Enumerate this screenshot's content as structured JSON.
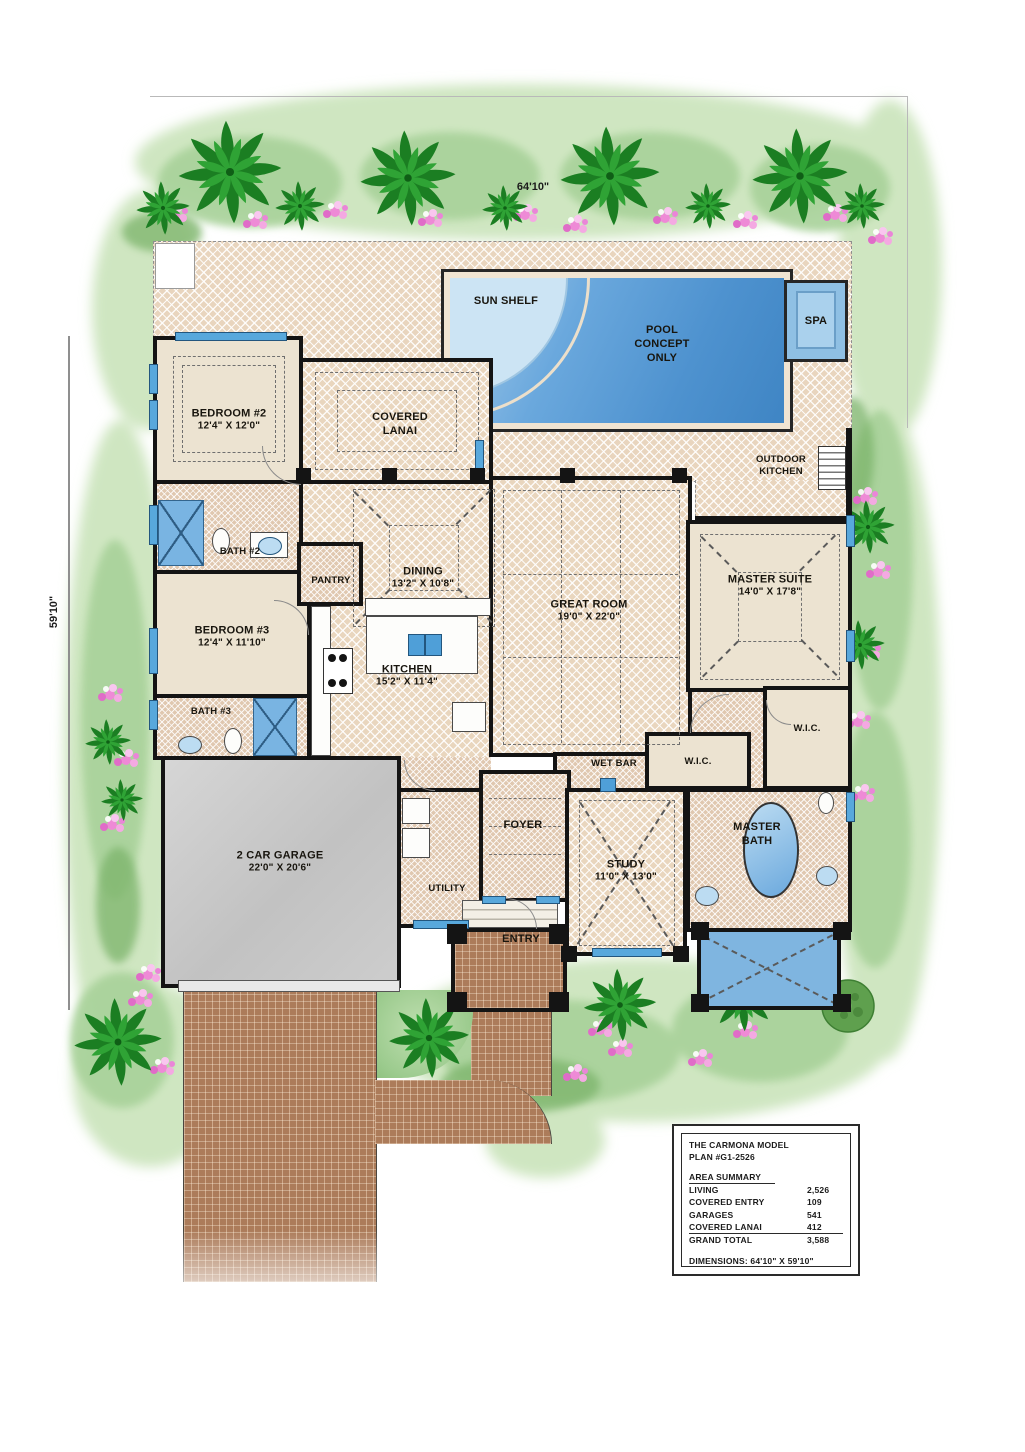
{
  "plan": {
    "top_dimension": "64'10\"",
    "left_dimension": "59'10\""
  },
  "rooms": {
    "sun_shelf": {
      "name": "SUN SHELF"
    },
    "pool": {
      "name": "POOL CONCEPT ONLY"
    },
    "spa": {
      "name": "SPA"
    },
    "outdoor_kitchen": {
      "name": "OUTDOOR KITCHEN"
    },
    "covered_lanai": {
      "name": "COVERED LANAI"
    },
    "bedroom2": {
      "name": "BEDROOM #2",
      "dims": "12'4\" X 12'0\""
    },
    "bath2": {
      "name": "BATH #2"
    },
    "pantry": {
      "name": "PANTRY"
    },
    "dining": {
      "name": "DINING",
      "dims": "13'2\" X 10'8\""
    },
    "great_room": {
      "name": "GREAT ROOM",
      "dims": "19'0\" X 22'0\""
    },
    "master_suite": {
      "name": "MASTER SUITE",
      "dims": "14'0\" X 17'8\""
    },
    "bedroom3": {
      "name": "BEDROOM #3",
      "dims": "12'4\" X 11'10\""
    },
    "bath3": {
      "name": "BATH #3"
    },
    "kitchen": {
      "name": "KITCHEN",
      "dims": "15'2\" X 11'4\""
    },
    "wet_bar": {
      "name": "WET BAR"
    },
    "wic_hall": {
      "name": "W.I.C."
    },
    "wic_master": {
      "name": "W.I.C."
    },
    "garage": {
      "name": "2 CAR GARAGE",
      "dims": "22'0\" X 20'6\""
    },
    "utility": {
      "name": "UTILITY"
    },
    "foyer": {
      "name": "FOYER"
    },
    "study": {
      "name": "STUDY",
      "dims": "11'0\" X 13'0\""
    },
    "master_bath": {
      "name": "MASTER BATH"
    },
    "entry": {
      "name": "ENTRY"
    }
  },
  "title_block": {
    "line1": "THE CARMONA  MODEL",
    "line2": "PLAN #G1-2526",
    "section": "AREA SUMMARY",
    "rows": [
      {
        "label": "LIVING",
        "value": "2,526"
      },
      {
        "label": "COVERED ENTRY",
        "value": "109"
      },
      {
        "label": "GARAGES",
        "value": "541"
      },
      {
        "label": "COVERED LANAI",
        "value": "412"
      },
      {
        "label": "GRAND TOTAL",
        "value": "3,588"
      }
    ],
    "dimensions": "DIMENSIONS: 64'10\" X 59'10\""
  },
  "colors": {
    "wall": "#141414",
    "deck": "#efe0cb",
    "floor": "#ece3d1",
    "tile": "#ecd9c4",
    "pool": "#4e92cf",
    "pool_light": "#cce4f4",
    "window": "#58a8dc",
    "brick": "#b5825f",
    "garage": "#c9c9c9",
    "green_light": "#cfe6c1",
    "green_mid": "#a8d29a",
    "palm": "#1b7e22",
    "palm2": "#2fa335",
    "flower": "#ee8ad6"
  }
}
